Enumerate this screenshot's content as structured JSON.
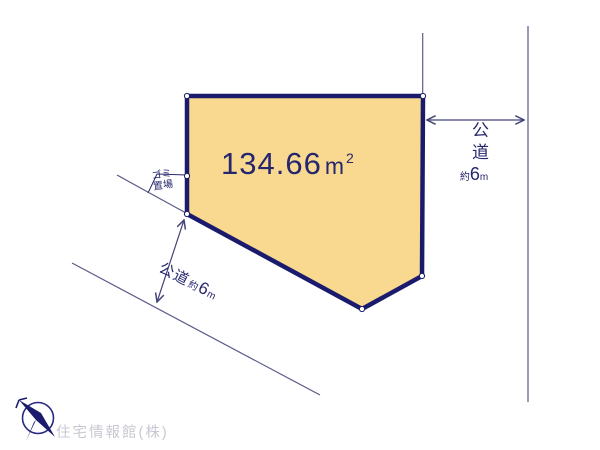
{
  "diagram": {
    "parcel": {
      "area_value": "134.66",
      "area_unit_base": "m",
      "area_unit_exponent": "2"
    },
    "garbage_area": {
      "label_line1": "ゴミ",
      "label_line2": "置場"
    },
    "road_right": {
      "name": "公道",
      "width_approx_prefix": "約",
      "width_value": "6",
      "width_unit": "m"
    },
    "road_left": {
      "name": "公道",
      "width_approx_prefix": "約",
      "width_value": "6",
      "width_unit": "m"
    },
    "watermark": "住宅情報館(株)",
    "icons": {
      "compass": "compass-north-icon"
    },
    "colors": {
      "parcel_fill": "#F8D98F",
      "parcel_border": "#1B1B6E",
      "text_navy": "#26266E",
      "thin_line": "#5B5B8B",
      "watermark_gray": "#C8C8D2"
    }
  }
}
